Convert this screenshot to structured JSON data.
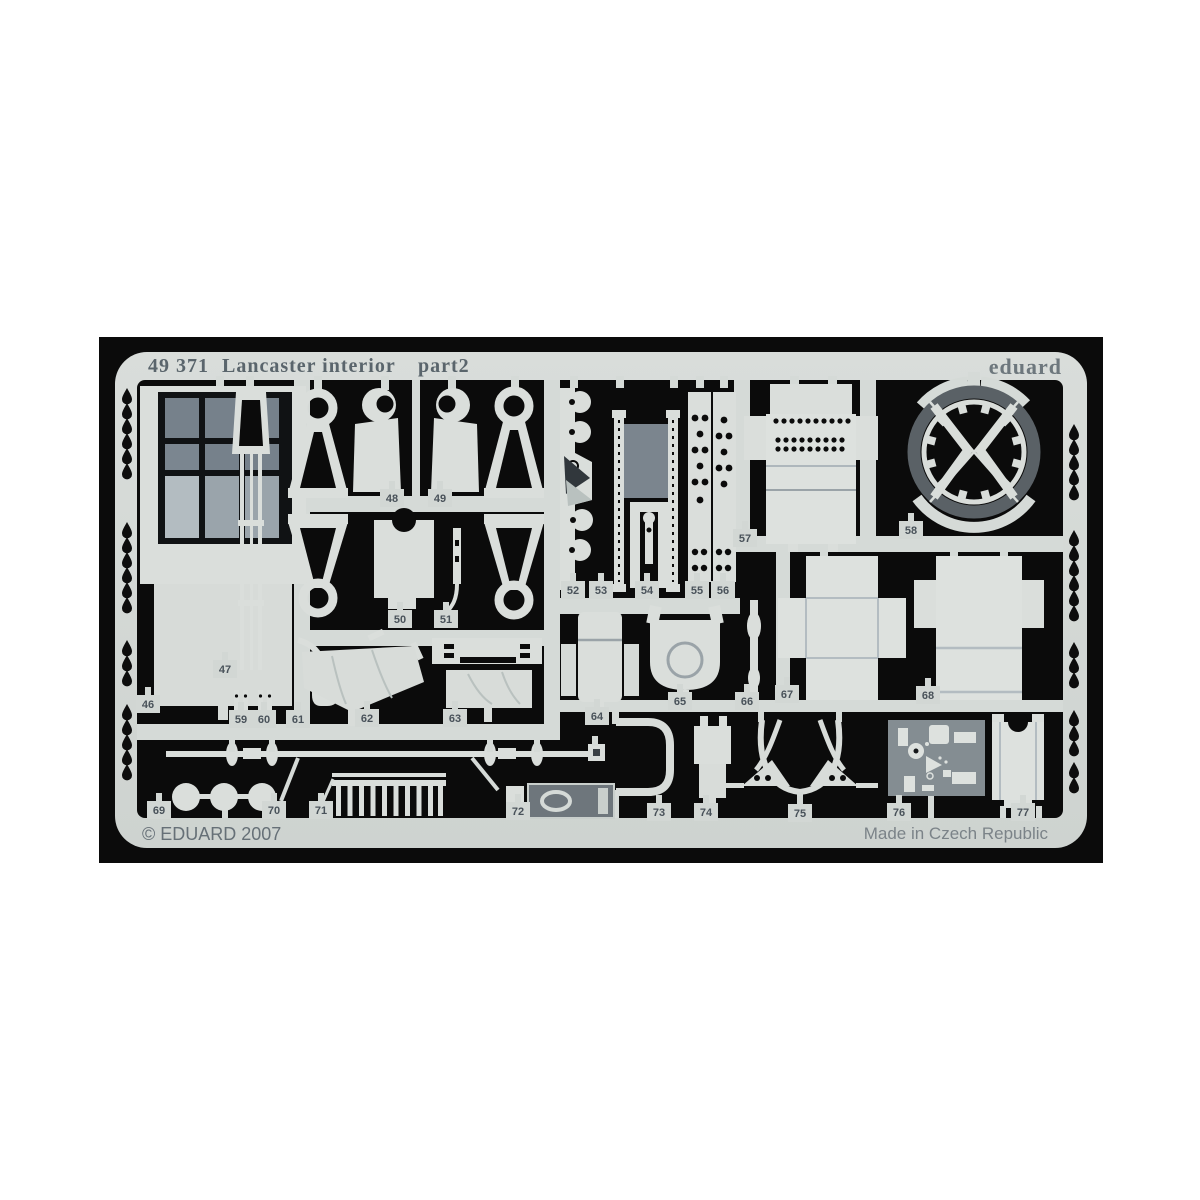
{
  "photo": {
    "sheet_code": "49 371",
    "sheet_title": "Lancaster interior",
    "sheet_part": "part2",
    "brand": "eduard",
    "copyright": "© EDUARD 2007",
    "made_in": "Made in Czech Republic",
    "colors": {
      "background": "#0b0b0b",
      "metal": "#d3d8d5",
      "part_metal": "#dadedb",
      "etched_gray": "#7e8891",
      "panel_gray": "#848d92",
      "ring_rim": "#5a6166",
      "header_text": "#5a656c",
      "footer_text": "#6e777d",
      "number_text": "#49525a"
    },
    "parts": [
      {
        "number": "46",
        "x": 148,
        "y": 704
      },
      {
        "number": "47",
        "x": 225,
        "y": 669
      },
      {
        "number": "48",
        "x": 392,
        "y": 498
      },
      {
        "number": "49",
        "x": 440,
        "y": 498
      },
      {
        "number": "50",
        "x": 400,
        "y": 619
      },
      {
        "number": "51",
        "x": 446,
        "y": 619
      },
      {
        "number": "52",
        "x": 573,
        "y": 590
      },
      {
        "number": "53",
        "x": 601,
        "y": 590
      },
      {
        "number": "54",
        "x": 647,
        "y": 590
      },
      {
        "number": "55",
        "x": 697,
        "y": 590
      },
      {
        "number": "56",
        "x": 723,
        "y": 590
      },
      {
        "number": "57",
        "x": 745,
        "y": 538
      },
      {
        "number": "58",
        "x": 911,
        "y": 530
      },
      {
        "number": "59",
        "x": 241,
        "y": 719
      },
      {
        "number": "60",
        "x": 264,
        "y": 719
      },
      {
        "number": "61",
        "x": 298,
        "y": 719
      },
      {
        "number": "62",
        "x": 367,
        "y": 718
      },
      {
        "number": "63",
        "x": 455,
        "y": 718
      },
      {
        "number": "64",
        "x": 597,
        "y": 716
      },
      {
        "number": "65",
        "x": 680,
        "y": 701
      },
      {
        "number": "66",
        "x": 747,
        "y": 701
      },
      {
        "number": "67",
        "x": 787,
        "y": 694
      },
      {
        "number": "68",
        "x": 928,
        "y": 695
      },
      {
        "number": "69",
        "x": 159,
        "y": 810
      },
      {
        "number": "70",
        "x": 274,
        "y": 810
      },
      {
        "number": "71",
        "x": 321,
        "y": 810
      },
      {
        "number": "72",
        "x": 518,
        "y": 811
      },
      {
        "number": "73",
        "x": 659,
        "y": 812
      },
      {
        "number": "74",
        "x": 706,
        "y": 812
      },
      {
        "number": "75",
        "x": 800,
        "y": 813
      },
      {
        "number": "76",
        "x": 899,
        "y": 812
      },
      {
        "number": "77",
        "x": 1023,
        "y": 812
      }
    ]
  }
}
